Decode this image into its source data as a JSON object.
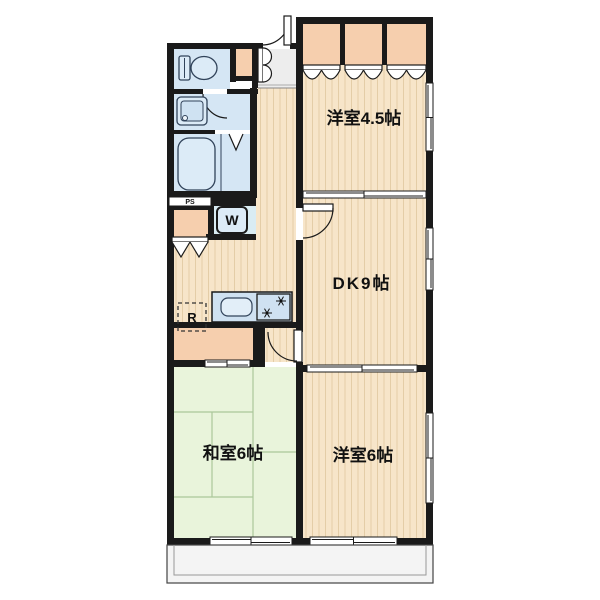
{
  "plan": {
    "rooms": {
      "western45": {
        "label": "洋室4.5帖"
      },
      "dk": {
        "label": "DK9帖"
      },
      "washitsu": {
        "label": "和室6帖"
      },
      "western6": {
        "label": "洋室6帖"
      }
    },
    "labels": {
      "washer": "W",
      "refrigerator": "R",
      "pipe_space": "PS"
    },
    "colors": {
      "wall": "#1a1a1a",
      "wood_floor": "#f7e5c9",
      "wood_stripe": "#e4cda7",
      "tatami": "#e9f4db",
      "closet": "#f6cfae",
      "water_room": "#d5e6f4",
      "fixture": "#dcebf7",
      "entry": "#ededed",
      "balcony": "#f4f4f4"
    }
  }
}
